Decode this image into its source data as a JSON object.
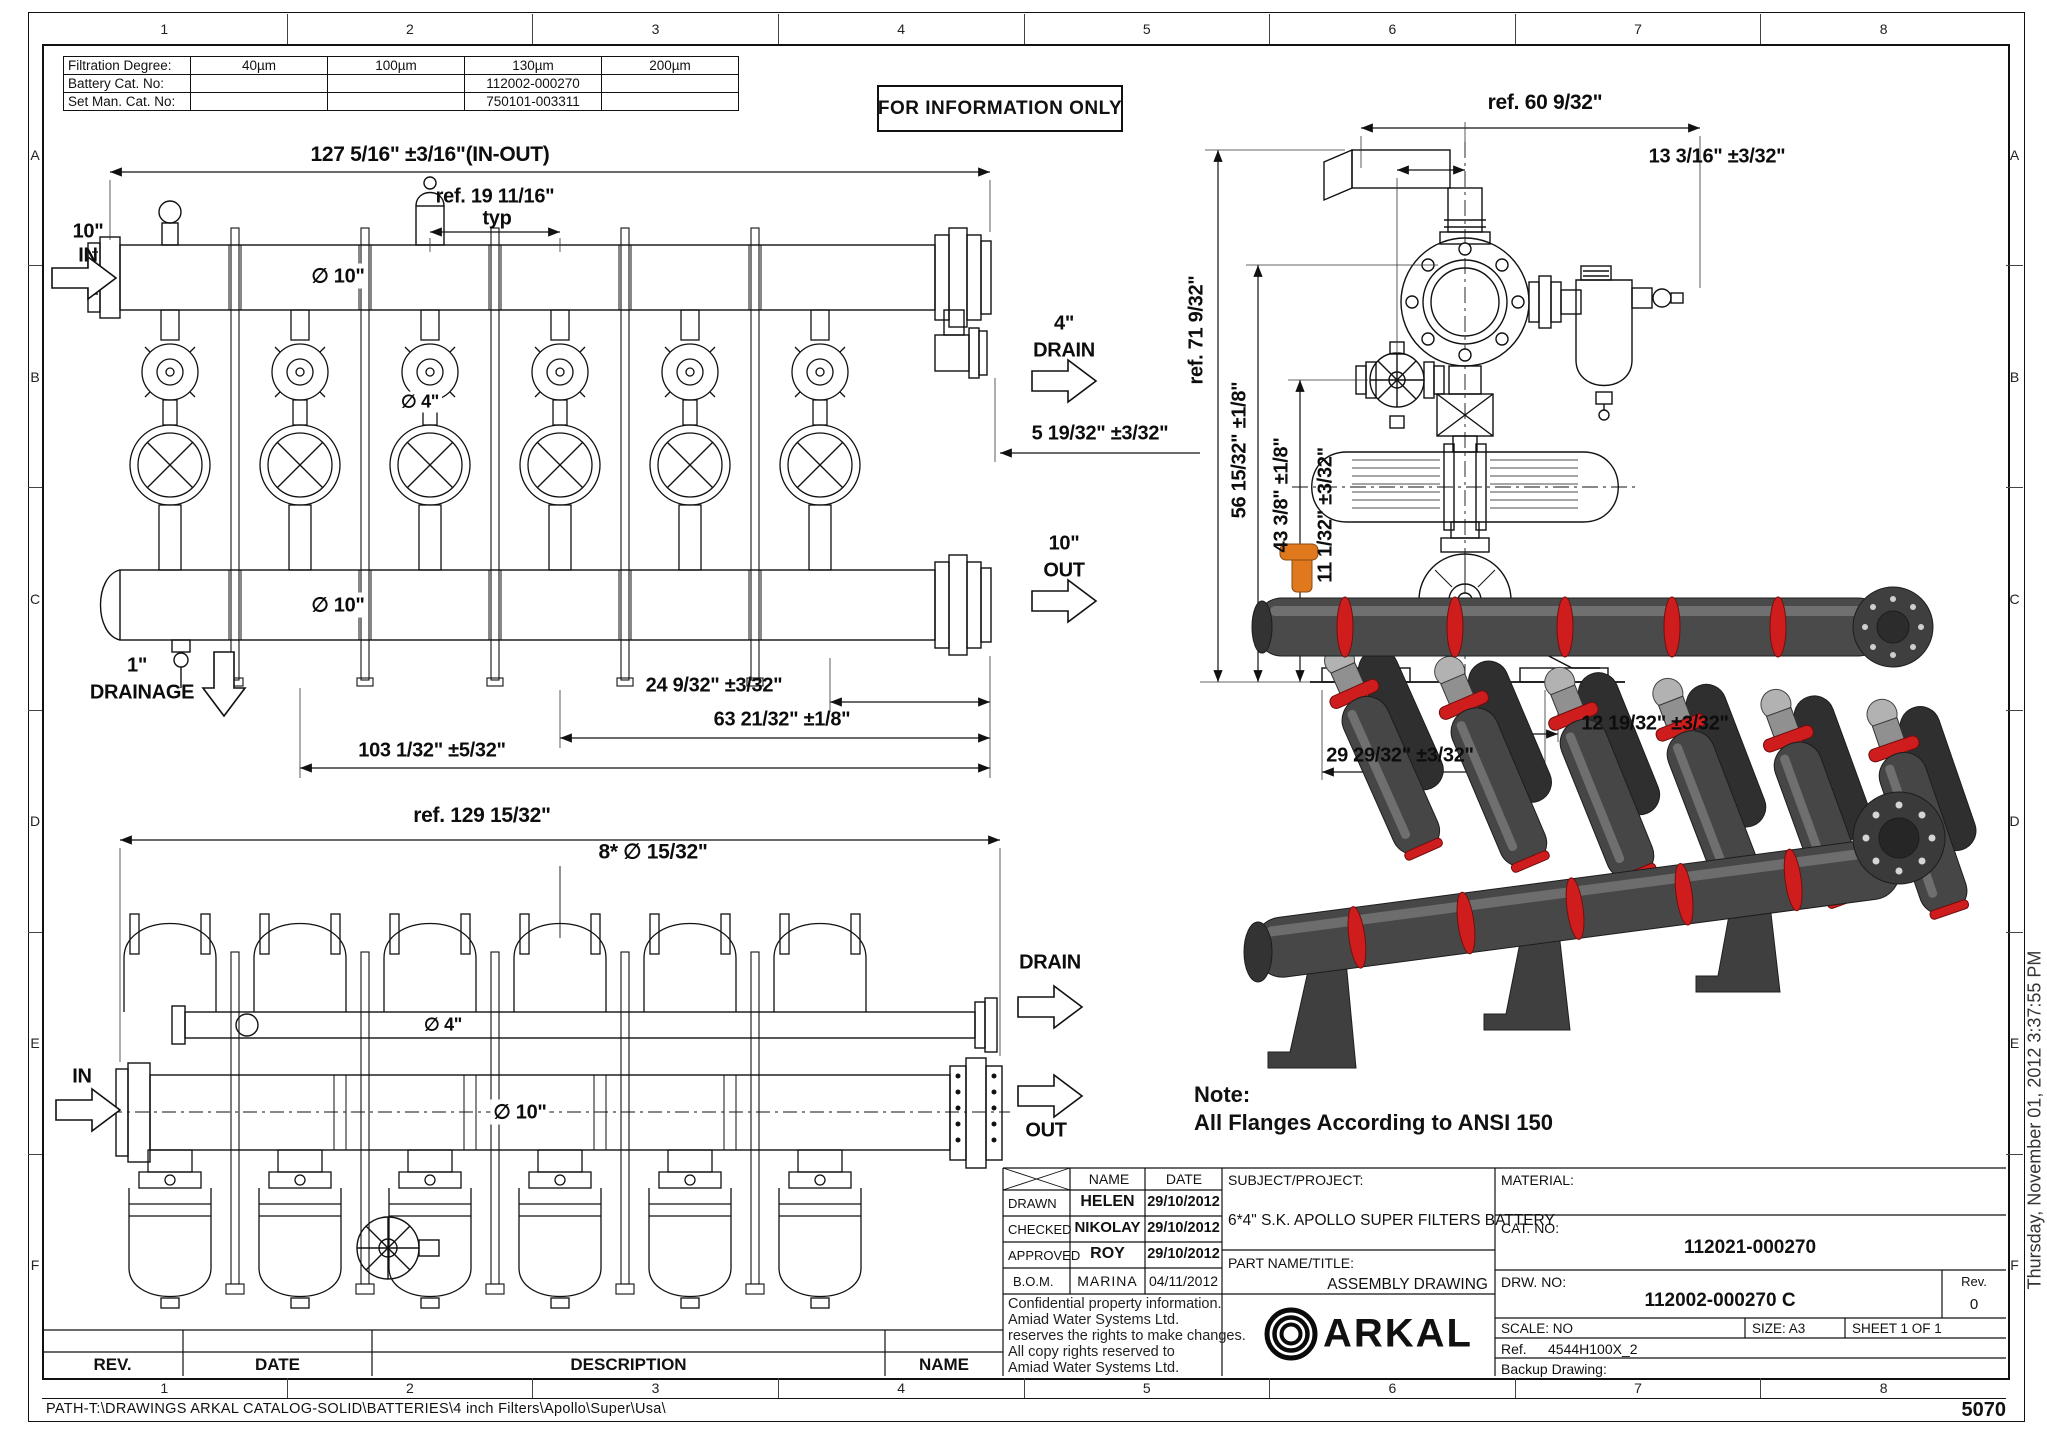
{
  "sheet": {
    "stamp": "FOR INFORMATION ONLY",
    "page_number": "5070",
    "path": "PATH-T:\\DRAWINGS ARKAL CATALOG-SOLID\\BATTERIES\\4 inch Filters\\Apollo\\Super\\Usa\\",
    "timestamp": "Thursday, November 01, 2012 3:37:55 PM"
  },
  "grid": {
    "cols": [
      "1",
      "2",
      "3",
      "4",
      "5",
      "6",
      "7",
      "8"
    ],
    "rows": [
      "A",
      "B",
      "C",
      "D",
      "E",
      "F"
    ]
  },
  "filtration_table": {
    "rows": [
      {
        "label": "Filtration Degree:",
        "values": [
          "40µm",
          "100µm",
          "130µm",
          "200µm"
        ]
      },
      {
        "label": "Battery Cat. No:",
        "values": [
          "",
          "",
          "112002-000270",
          ""
        ]
      },
      {
        "label": "Set Man. Cat. No:",
        "values": [
          "",
          "",
          "750101-003311",
          ""
        ]
      }
    ]
  },
  "front_view": {
    "dim_overall": "127 5/16\" ±3/16\"(IN-OUT)",
    "dim_typ_ref": "ref. 19 11/16\"",
    "typ": "typ",
    "in_size": "10\"",
    "in_label": "IN",
    "dia_top": "∅ 10\"",
    "dia_valve": "∅ 4\"",
    "drain_size": "4\"",
    "drain_label": "DRAIN",
    "dim_drain": "5 19/32\" ±3/32\"",
    "out_size": "10\"",
    "out_label": "OUT",
    "dia_bottom": "∅ 10\"",
    "drainage_size": "1\"",
    "drainage_label": "DRAINAGE",
    "dim_a": "24 9/32\" ±3/32\"",
    "dim_b": "63 21/32\" ±1/8\"",
    "dim_c": "103 1/32\" ±5/32\""
  },
  "plan_view": {
    "dim_overall": "ref. 129 15/32\"",
    "dim_holes": "8* ∅ 15/32\"",
    "dia_drain": "∅ 4\"",
    "dia_main": "∅ 10\"",
    "in_label": "IN",
    "drain_label": "DRAIN",
    "out_label": "OUT"
  },
  "side_view": {
    "dim_width": "ref. 60 9/32\"",
    "dim_top": "13 3/16\" ±3/32\"",
    "dim_height": "ref. 71 9/32\"",
    "dim_b": "56 15/32\" ±1/8\"",
    "dim_c": "43 3/8\" ±1/8\"",
    "dim_d": "11 1/32\" ±3/32\"",
    "dim_e": "12 19/32\" ±3/32\"",
    "dim_f": "29 29/32\" ±3/32\""
  },
  "note": {
    "title": "Note:",
    "text": "All Flanges According to ANSI 150"
  },
  "title_block": {
    "name_header": "NAME",
    "date_header": "DATE",
    "rows": [
      {
        "role": "DRAWN",
        "name": "HELEN",
        "date": "29/10/2012"
      },
      {
        "role": "CHECKED",
        "name": "NIKOLAY",
        "date": "29/10/2012"
      },
      {
        "role": "APPROVED",
        "name": "ROY",
        "date": "29/10/2012"
      },
      {
        "role": "B.O.M.",
        "name": "MARINA",
        "date": "04/11/2012"
      }
    ],
    "confidential": [
      "Confidential property information.",
      "Amiad Water Systems Ltd.",
      "reserves the rights to make changes.",
      "All copy rights reserved to",
      "Amiad Water Systems Ltd."
    ],
    "subject_label": "SUBJECT/PROJECT:",
    "subject_value": "6*4\" S.K. APOLLO SUPER FILTERS BATTERY",
    "part_label": "PART NAME/TITLE:",
    "part_value": "ASSEMBLY DRAWING",
    "material_label": "MATERIAL:",
    "cat_label": "CAT. NO:",
    "cat_value": "112021-000270",
    "drw_label": "DRW. NO:",
    "drw_value": "112002-000270 C",
    "rev_label": "Rev.",
    "rev_value": "0",
    "scale": "SCALE: NO",
    "size": "SIZE: A3",
    "sheet": "SHEET 1 OF 1",
    "ref_label": "Ref.",
    "ref_value": "4544H100X_2",
    "backup_label": "Backup Drawing:",
    "logo_text": "ARKAL"
  },
  "revision_strip": {
    "rev": "REV.",
    "date": "DATE",
    "description": "DESCRIPTION",
    "name": "NAME"
  },
  "colors": {
    "line": "#1a1a1a",
    "render_dark": "#464646",
    "render_red": "#cf1d1d",
    "render_orange": "#e0791e"
  }
}
